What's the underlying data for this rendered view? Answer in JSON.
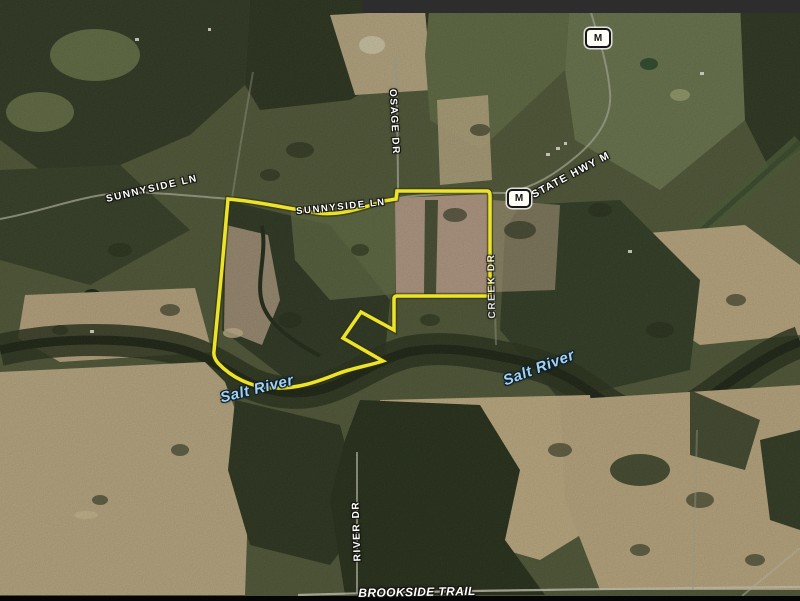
{
  "map": {
    "type": "satellite-parcel-map",
    "boundary_color": "#ece32d",
    "labels": {
      "sunnyside_west": "SUNNYSIDE LN",
      "sunnyside_center": "SUNNYSIDE LN",
      "osage_dr": "OSAGE DR",
      "state_hwy_m": "STATE HWY M",
      "creek_dr": "CREEK DR",
      "river_dr": "RIVER DR",
      "brookside_trail": "BROOKSIDE TRAIL",
      "salt_river_west": "Salt River",
      "salt_river_east": "Salt River"
    },
    "badges": {
      "hwy_m_top": "M",
      "hwy_m_mid": "M"
    }
  }
}
